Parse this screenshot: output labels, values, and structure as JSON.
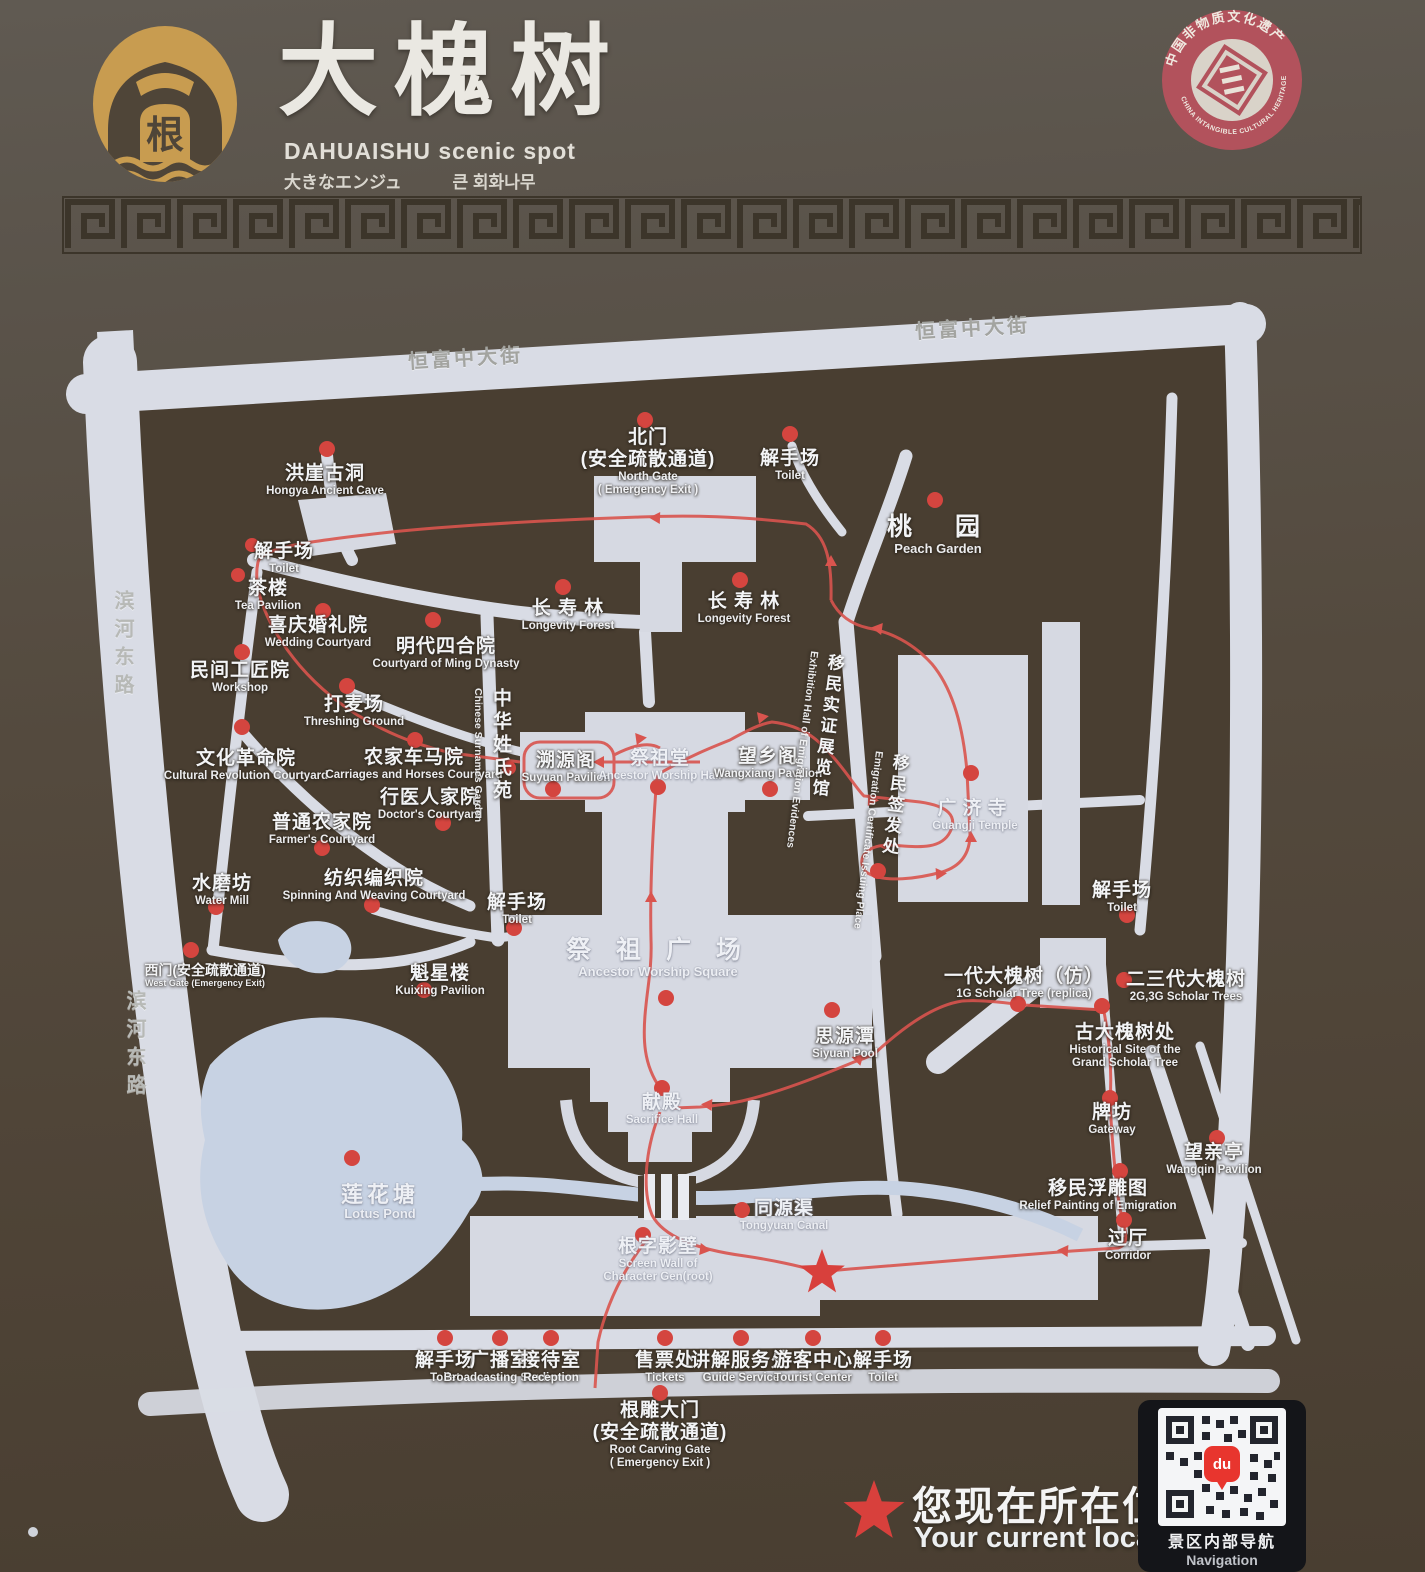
{
  "header": {
    "logo_text": "根",
    "title_cn": "大槐树",
    "title_en": "DAHUAISHU scenic spot",
    "title_ja": "大きなエンジュ",
    "title_ko": "큰 회화나무",
    "badge_top": "中国非物质文化遗产",
    "badge_bottom": "CHINA INTANGIBLE CULTURAL HERITAGE"
  },
  "streets": {
    "north1": "恒富中大街",
    "north2": "恒富中大街",
    "west1": "滨河东路",
    "west2": "滨河东路"
  },
  "pois": [
    {
      "cn": "北门",
      "cn2": "(安全疏散通道)",
      "en": "North Gate",
      "en2": "( Emergency Exit )"
    },
    {
      "cn": "解手场",
      "en": "Toilet"
    },
    {
      "cn": "桃　园",
      "en": "Peach Garden"
    },
    {
      "cn": "洪崖古洞",
      "en": "Hongya Ancient Cave"
    },
    {
      "cn": "解手场",
      "en": "Toilet"
    },
    {
      "cn": "茶楼",
      "en": "Tea Pavilion"
    },
    {
      "cn": "喜庆婚礼院",
      "en": "Wedding Courtyard"
    },
    {
      "cn": "明代四合院",
      "en": "Courtyard of Ming Dynasty"
    },
    {
      "cn": "民间工匠院",
      "en": "Workshop"
    },
    {
      "cn": "打麦场",
      "en": "Threshing Ground"
    },
    {
      "cn": "文化革命院",
      "en": "Cultural Revolution Courtyard"
    },
    {
      "cn": "农家车马院",
      "en": "Carriages and Horses Courtyard"
    },
    {
      "cn": "行医人家院",
      "en": "Doctor's Courtyard"
    },
    {
      "cn": "普通农家院",
      "en": "Farmer's Courtyard"
    },
    {
      "cn": "水磨坊",
      "en": "Water Mill"
    },
    {
      "cn": "纺织编织院",
      "en": "Spinning And Weaving Courtyard"
    },
    {
      "cn": "西门(安全疏散通道)",
      "en": "West Gate  (Emergency Exit)"
    },
    {
      "cn": "魁星楼",
      "en": "Kuixing Pavilion"
    },
    {
      "cn": "解手场",
      "en": "Toilet"
    },
    {
      "cn": "中华姓氏苑",
      "en": "Chinese Surnames Garden"
    },
    {
      "cn": "溯源阁",
      "en": "Suyuan Pavilion"
    },
    {
      "cn": "祭祖堂",
      "en": "Ancestor Worship Hall"
    },
    {
      "cn": "望乡阁",
      "en": "Wangxiang Pavilion"
    },
    {
      "cn": "移民实证展览馆",
      "en": "Exhibition Hall of Emigration Evidences"
    },
    {
      "cn": "移民签发处",
      "en": "Emigration Certificate Issuing Place"
    },
    {
      "cn": "广济寺",
      "en": "Guangji Temple"
    },
    {
      "cn": "解手场",
      "en": "Toilet"
    },
    {
      "cn": "祭 祖 广 场",
      "en": "Ancestor Worship Square"
    },
    {
      "cn": "思源潭",
      "en": "Siyuan Pool"
    },
    {
      "cn": "一代大槐树（仿）",
      "en": "1G Scholar Tree (replica)"
    },
    {
      "cn": "二三代大槐树",
      "en": "2G,3G Scholar Trees"
    },
    {
      "cn": "古大槐树处",
      "en": "Historical Site of the",
      "en2": "Grand Scholar Tree"
    },
    {
      "cn": "牌坊",
      "en": "Gateway"
    },
    {
      "cn": "望亲亭",
      "en": "Wangqin Pavilion"
    },
    {
      "cn": "移民浮雕图",
      "en": "Relief Painting of Emigration"
    },
    {
      "cn": "过厅",
      "en": "Corridor"
    },
    {
      "cn": "莲花塘",
      "en": "Lotus Pond"
    },
    {
      "cn": "同源渠",
      "en": "Tongyuan Canal"
    },
    {
      "cn": "根字影壁",
      "en": "Screen Wall of",
      "en2": "Character Gen(root)"
    },
    {
      "cn": "献殿",
      "en": "Sacrifice Hall"
    },
    {
      "cn": "长 寿 林",
      "en": "Longevity Forest"
    },
    {
      "cn": "长 寿 林",
      "en": "Longevity Forest"
    },
    {
      "cn": "解手场",
      "en": "Toilet"
    },
    {
      "cn": "广播室",
      "en": "Broadcasting Studio"
    },
    {
      "cn": "接待室",
      "en": "Reception"
    },
    {
      "cn": "售票处",
      "en": "Tickets"
    },
    {
      "cn": "讲解服务处",
      "en": "Guide Service"
    },
    {
      "cn": "游客中心",
      "en": "Tourist Center"
    },
    {
      "cn": "解手场",
      "en": "Toilet"
    },
    {
      "cn": "根雕大门",
      "cn2": "(安全疏散通道)",
      "en": "Root Carving Gate",
      "en2": "( Emergency Exit )"
    }
  ],
  "legend": {
    "cn": "您现在所在位置",
    "en": "Your current location"
  },
  "qr": {
    "pin": "du",
    "caption_cn": "景区内部导航",
    "caption_en": "Navigation"
  },
  "colors": {
    "sign_top": "#5d574f",
    "sign_bottom": "#493e31",
    "map_light": "#d7dae3",
    "pond_blue": "#c7d2e3",
    "marker_red": "#d4453f",
    "route_red": "#d9544e",
    "logo_gold": "#c89c50",
    "badge_red": "#b2525c"
  }
}
